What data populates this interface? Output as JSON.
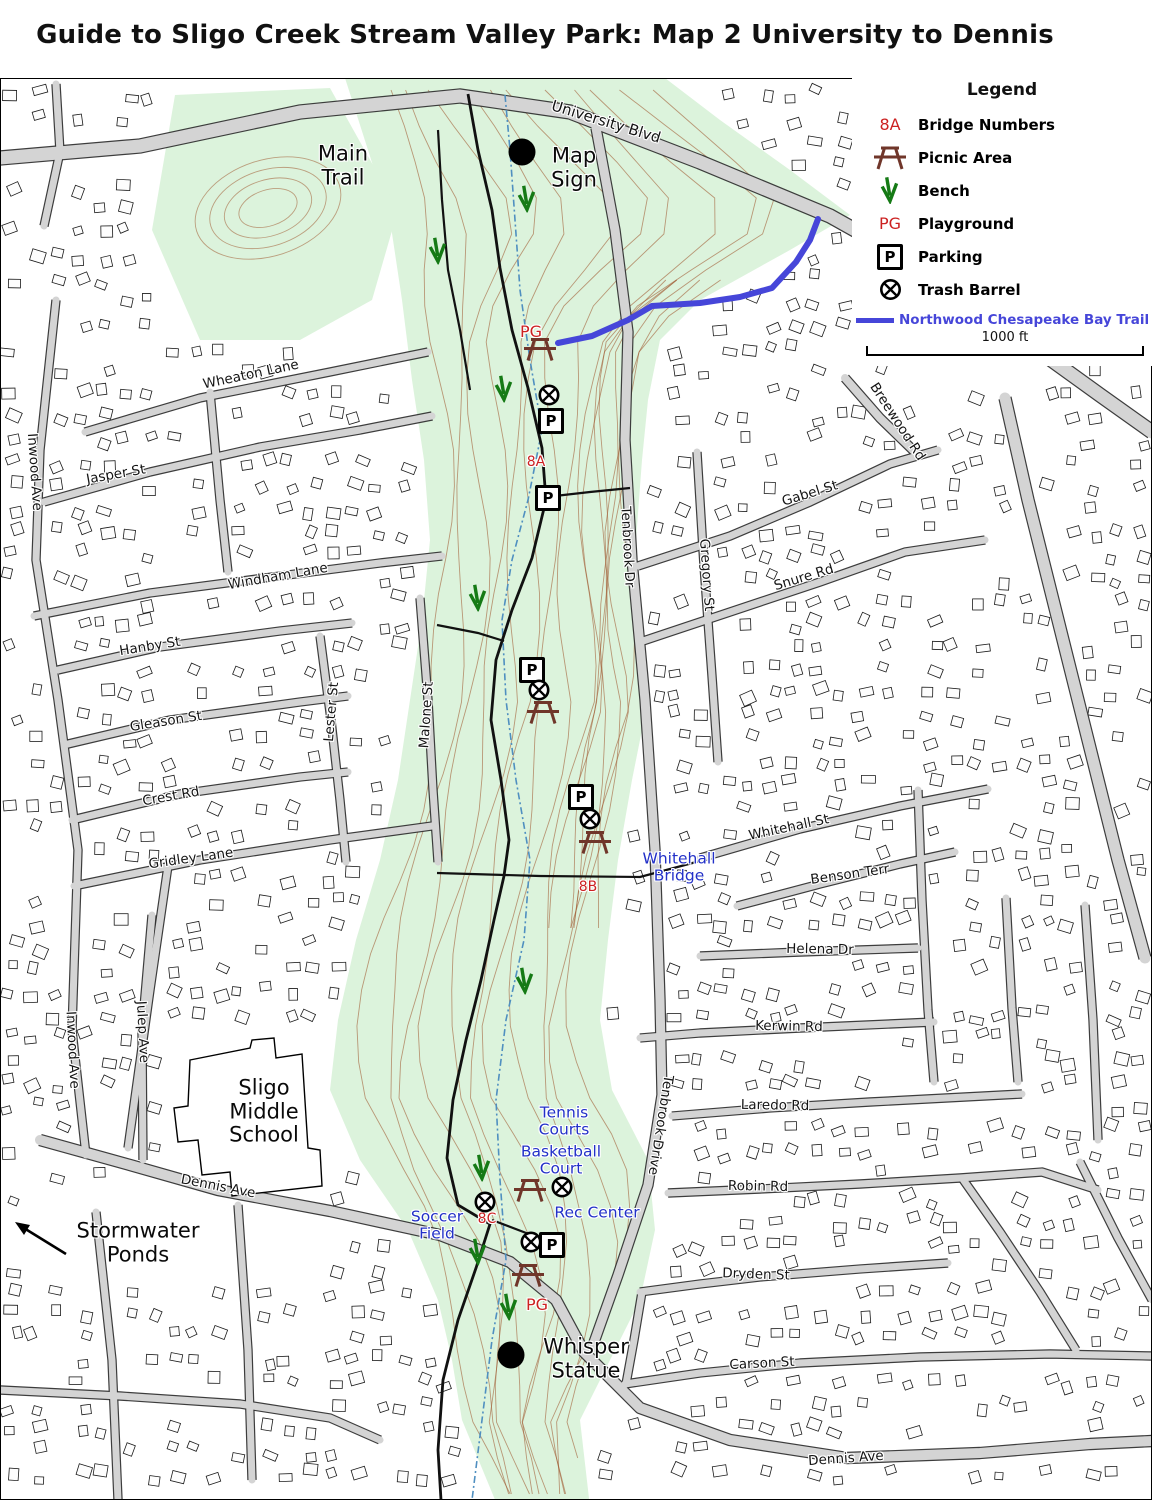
{
  "title": "Guide to Sligo Creek Stream Valley Park: Map 2 University to Dennis",
  "legend": {
    "title": "Legend",
    "items": [
      {
        "type": "bridge-number",
        "symbol": "8A",
        "label": "Bridge Numbers"
      },
      {
        "type": "picnic-area",
        "label": "Picnic Area"
      },
      {
        "type": "bench",
        "label": "Bench"
      },
      {
        "type": "playground",
        "symbol": "PG",
        "label": "Playground"
      },
      {
        "type": "parking",
        "symbol": "P",
        "label": "Parking"
      },
      {
        "type": "trash-barrel",
        "label": "Trash Barrel"
      }
    ],
    "trail": {
      "label": "Northwood Chesapeake Bay Trail",
      "color": "#4646d9"
    },
    "scale_label": "1000 ft"
  },
  "colors": {
    "park_green": "#dcf3dc",
    "trail_blue": "#4646d9",
    "poi_blue": "#2230c8",
    "marker_red": "#cc2222",
    "bench_green": "#157a15",
    "picnic_brown": "#70362a",
    "contour": "#a05a32",
    "road_fill": "#d4d4d4",
    "road_casing": "#333333",
    "water_blue": "#4f8fc0"
  },
  "streets": [
    {
      "name": "University Blvd",
      "x": 606,
      "y": 122,
      "rot": 17,
      "size": 15
    },
    {
      "name": "Wheaton Lane",
      "x": 251,
      "y": 375,
      "rot": -12
    },
    {
      "name": "Inwood Ave",
      "x": 34,
      "y": 472,
      "rot": 86
    },
    {
      "name": "Jasper St",
      "x": 116,
      "y": 475,
      "rot": -10
    },
    {
      "name": "Windham Lane",
      "x": 278,
      "y": 577,
      "rot": -10
    },
    {
      "name": "Hanby St",
      "x": 150,
      "y": 647,
      "rot": -9
    },
    {
      "name": "Gleason St",
      "x": 166,
      "y": 722,
      "rot": -9
    },
    {
      "name": "Crest Rd",
      "x": 171,
      "y": 797,
      "rot": -10
    },
    {
      "name": "Gridley Lane",
      "x": 191,
      "y": 859,
      "rot": -8
    },
    {
      "name": "Lester St",
      "x": 332,
      "y": 712,
      "rot": -85
    },
    {
      "name": "Malone St",
      "x": 427,
      "y": 715,
      "rot": -86
    },
    {
      "name": "Tenbrook Dr",
      "x": 627,
      "y": 547,
      "rot": 87
    },
    {
      "name": "Gregory St",
      "x": 706,
      "y": 575,
      "rot": 86
    },
    {
      "name": "Gabel St",
      "x": 810,
      "y": 494,
      "rot": -17
    },
    {
      "name": "Snure Rd",
      "x": 804,
      "y": 578,
      "rot": -17
    },
    {
      "name": "Breewood Rd",
      "x": 897,
      "y": 422,
      "rot": 57
    },
    {
      "name": "Whitehall St",
      "x": 789,
      "y": 828,
      "rot": -12
    },
    {
      "name": "Benson Terr",
      "x": 850,
      "y": 875,
      "rot": -8
    },
    {
      "name": "Helena Dr",
      "x": 820,
      "y": 950,
      "rot": 1
    },
    {
      "name": "Kerwin Rd",
      "x": 789,
      "y": 1027,
      "rot": 1
    },
    {
      "name": "Laredo Rd",
      "x": 775,
      "y": 1106,
      "rot": 1
    },
    {
      "name": "Robin Rd",
      "x": 758,
      "y": 1187,
      "rot": 1
    },
    {
      "name": "Tenbrook Drive",
      "x": 660,
      "y": 1125,
      "rot": 99
    },
    {
      "name": "Inwood Ave",
      "x": 72,
      "y": 1050,
      "rot": 87
    },
    {
      "name": "Julep Ave",
      "x": 142,
      "y": 1032,
      "rot": 87
    },
    {
      "name": "Dryden St",
      "x": 756,
      "y": 1275,
      "rot": 2
    },
    {
      "name": "Carson St",
      "x": 762,
      "y": 1364,
      "rot": -3
    },
    {
      "name": "Dennis Ave",
      "x": 218,
      "y": 1187,
      "rot": 11
    },
    {
      "name": "Dennis Ave",
      "x": 846,
      "y": 1459,
      "rot": -4
    }
  ],
  "pois": [
    {
      "label": "Whitehall\nBridge",
      "x": 679,
      "y": 868
    },
    {
      "label": "Tennis\nCourts",
      "x": 564,
      "y": 1122
    },
    {
      "label": "Basketball\nCourt",
      "x": 561,
      "y": 1161
    },
    {
      "label": "Rec Center",
      "x": 597,
      "y": 1213
    },
    {
      "label": "Soccer\nField",
      "x": 437,
      "y": 1226
    }
  ],
  "bridges": [
    {
      "label": "8A",
      "x": 536,
      "y": 463
    },
    {
      "label": "8B",
      "x": 588,
      "y": 888
    },
    {
      "label": "8C",
      "x": 487,
      "y": 1220
    }
  ],
  "playgrounds": [
    {
      "label": "PG",
      "x": 531,
      "y": 332
    },
    {
      "label": "PG",
      "x": 537,
      "y": 1305
    }
  ],
  "landmarks": [
    {
      "label": "Map\nSign",
      "dot_x": 522,
      "dot_y": 152,
      "x": 574,
      "y": 168
    },
    {
      "label": "Whisper\nStatue",
      "dot_x": 511,
      "dot_y": 1355,
      "x": 586,
      "y": 1359
    }
  ],
  "annotations": [
    {
      "label": "Main\nTrail",
      "x": 343,
      "y": 166
    },
    {
      "label": "Sligo\nMiddle\nSchool",
      "x": 264,
      "y": 1112
    },
    {
      "label": "Stormwater\nPonds",
      "x": 138,
      "y": 1243,
      "arrow": {
        "x1": 66,
        "y1": 1254,
        "x2": 15,
        "y2": 1222
      }
    }
  ],
  "markers": {
    "parking": [
      [
        551,
        421
      ],
      [
        548,
        498
      ],
      [
        532,
        670
      ],
      [
        581,
        797
      ],
      [
        552,
        1245
      ]
    ],
    "trash": [
      [
        549,
        397
      ],
      [
        539,
        692
      ],
      [
        590,
        821
      ],
      [
        562,
        1189
      ],
      [
        485,
        1204
      ],
      [
        531,
        1244
      ]
    ],
    "picnic": [
      [
        540,
        351
      ],
      [
        543,
        714
      ],
      [
        595,
        844
      ],
      [
        530,
        1192
      ],
      [
        528,
        1277
      ]
    ],
    "bench": [
      [
        527,
        201
      ],
      [
        438,
        253
      ],
      [
        504,
        391
      ],
      [
        478,
        600
      ],
      [
        525,
        983
      ],
      [
        482,
        1170
      ],
      [
        478,
        1254
      ],
      [
        509,
        1309
      ]
    ]
  }
}
